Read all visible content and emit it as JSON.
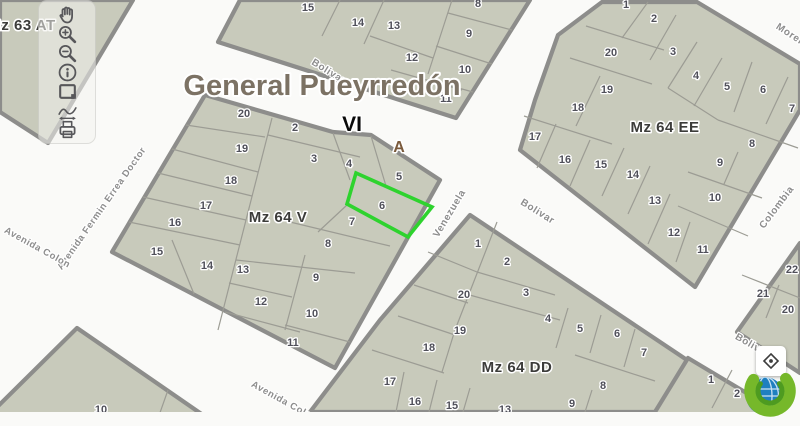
{
  "app": {
    "type": "gis-parcel-map-viewer"
  },
  "colors": {
    "street_bg": "#fafaf8",
    "block_fill": "#c8cabb",
    "block_stroke": "#8d8d8b",
    "parcel_line": "#9c9c94",
    "highlight": "#2ed32e"
  },
  "toolbar": {
    "items": [
      {
        "name": "pan",
        "title": "Pan"
      },
      {
        "name": "zoom-in",
        "title": "Zoom in"
      },
      {
        "name": "zoom-out",
        "title": "Zoom out"
      },
      {
        "name": "identify",
        "title": "Identify"
      },
      {
        "name": "zoom-extent",
        "title": "Zoom to extent"
      },
      {
        "name": "measure",
        "title": "Measure"
      },
      {
        "name": "print",
        "title": "Print"
      }
    ]
  },
  "controls": {
    "geolocate": {
      "title": "Locate"
    }
  },
  "map": {
    "blocks": [
      {
        "name": "mz-63-at",
        "label": "Mz 63 AT",
        "label_x": 22,
        "label_y": 30,
        "polygon": [
          [
            0,
            0
          ],
          [
            133,
            0
          ],
          [
            48,
            143
          ],
          [
            0,
            112
          ]
        ],
        "dividers": [],
        "parcels": []
      },
      {
        "name": "north-block",
        "polygon": [
          [
            240,
            0
          ],
          [
            530,
            0
          ],
          [
            456,
            118
          ],
          [
            218,
            42
          ]
        ],
        "dividers": [
          [
            340,
            0,
            322,
            36
          ],
          [
            384,
            0,
            364,
            44
          ],
          [
            370,
            36,
            433,
            58
          ],
          [
            391,
            70,
            462,
            90
          ],
          [
            452,
            0,
            428,
            74
          ],
          [
            448,
            13,
            512,
            30
          ],
          [
            436,
            46,
            492,
            64
          ],
          [
            429,
            80,
            473,
            92
          ]
        ],
        "parcels": [
          {
            "n": "15",
            "x": 308,
            "y": 7
          },
          {
            "n": "14",
            "x": 358,
            "y": 22
          },
          {
            "n": "13",
            "x": 394,
            "y": 25
          },
          {
            "n": "8",
            "x": 478,
            "y": 3
          },
          {
            "n": "9",
            "x": 469,
            "y": 33
          },
          {
            "n": "12",
            "x": 412,
            "y": 57
          },
          {
            "n": "10",
            "x": 465,
            "y": 69
          },
          {
            "n": "11",
            "x": 446,
            "y": 98
          }
        ]
      },
      {
        "name": "mz-64-v",
        "label": "Mz 64 V",
        "label_x": 278,
        "label_y": 222,
        "polygon": [
          [
            205,
            95
          ],
          [
            333,
            132
          ],
          [
            371,
            135
          ],
          [
            440,
            180
          ],
          [
            335,
            368
          ],
          [
            112,
            252
          ]
        ],
        "dividers": [
          [
            186,
            125,
            265,
            137
          ],
          [
            172,
            149,
            258,
            172
          ],
          [
            158,
            173,
            252,
            196
          ],
          [
            143,
            197,
            246,
            220
          ],
          [
            129,
            222,
            240,
            245
          ],
          [
            272,
            118,
            218,
            330
          ],
          [
            172,
            240,
            194,
            294
          ],
          [
            229,
            283,
            292,
            297
          ],
          [
            225,
            312,
            300,
            332
          ],
          [
            236,
            260,
            355,
            273
          ],
          [
            305,
            255,
            285,
            330
          ],
          [
            285,
            325,
            350,
            342
          ],
          [
            290,
            222,
            390,
            246
          ],
          [
            268,
            135,
            360,
            157
          ],
          [
            333,
            133,
            350,
            180
          ],
          [
            371,
            136,
            386,
            186
          ],
          [
            347,
            205,
            318,
            232
          ]
        ],
        "parcels": [
          {
            "n": "20",
            "x": 244,
            "y": 113
          },
          {
            "n": "2",
            "x": 295,
            "y": 127
          },
          {
            "n": "19",
            "x": 242,
            "y": 148
          },
          {
            "n": "3",
            "x": 314,
            "y": 158
          },
          {
            "n": "4",
            "x": 349,
            "y": 163
          },
          {
            "n": "5",
            "x": 399,
            "y": 176
          },
          {
            "n": "18",
            "x": 231,
            "y": 180
          },
          {
            "n": "6",
            "x": 382,
            "y": 205
          },
          {
            "n": "17",
            "x": 206,
            "y": 205
          },
          {
            "n": "7",
            "x": 352,
            "y": 221
          },
          {
            "n": "16",
            "x": 175,
            "y": 222
          },
          {
            "n": "8",
            "x": 328,
            "y": 243
          },
          {
            "n": "15",
            "x": 157,
            "y": 251
          },
          {
            "n": "14",
            "x": 207,
            "y": 265
          },
          {
            "n": "13",
            "x": 243,
            "y": 269
          },
          {
            "n": "9",
            "x": 316,
            "y": 277
          },
          {
            "n": "12",
            "x": 261,
            "y": 301
          },
          {
            "n": "10",
            "x": 312,
            "y": 313
          },
          {
            "n": "11",
            "x": 293,
            "y": 342
          }
        ]
      },
      {
        "name": "mz-64-ee",
        "label": "Mz 64 EE",
        "label_x": 665,
        "label_y": 132,
        "polygon": [
          [
            520,
            150
          ],
          [
            535,
            100
          ],
          [
            558,
            35
          ],
          [
            602,
            2
          ],
          [
            697,
            2
          ],
          [
            800,
            64
          ],
          [
            800,
            110
          ],
          [
            695,
            287
          ]
        ],
        "dividers": [
          [
            648,
            2,
            622,
            38
          ],
          [
            676,
            15,
            650,
            60
          ],
          [
            697,
            42,
            668,
            88
          ],
          [
            722,
            58,
            694,
            106
          ],
          [
            752,
            62,
            734,
            112
          ],
          [
            788,
            77,
            766,
            124
          ],
          [
            718,
            120,
            798,
            148
          ],
          [
            738,
            152,
            724,
            184
          ],
          [
            688,
            172,
            762,
            198
          ],
          [
            678,
            206,
            748,
            236
          ],
          [
            690,
            222,
            676,
            262
          ],
          [
            670,
            194,
            648,
            244
          ],
          [
            650,
            166,
            628,
            214
          ],
          [
            624,
            148,
            602,
            196
          ],
          [
            590,
            140,
            570,
            186
          ],
          [
            556,
            124,
            537,
            168
          ],
          [
            524,
            116,
            612,
            144
          ],
          [
            600,
            76,
            576,
            126
          ],
          [
            570,
            58,
            652,
            84
          ],
          [
            586,
            26,
            664,
            50
          ],
          [
            668,
            88,
            718,
            120
          ]
        ],
        "parcels": [
          {
            "n": "1",
            "x": 626,
            "y": 4
          },
          {
            "n": "2",
            "x": 654,
            "y": 18
          },
          {
            "n": "20",
            "x": 611,
            "y": 52
          },
          {
            "n": "3",
            "x": 673,
            "y": 51
          },
          {
            "n": "4",
            "x": 696,
            "y": 75
          },
          {
            "n": "5",
            "x": 727,
            "y": 86
          },
          {
            "n": "6",
            "x": 763,
            "y": 89
          },
          {
            "n": "19",
            "x": 607,
            "y": 89
          },
          {
            "n": "7",
            "x": 792,
            "y": 108
          },
          {
            "n": "18",
            "x": 578,
            "y": 107
          },
          {
            "n": "17",
            "x": 535,
            "y": 136
          },
          {
            "n": "8",
            "x": 752,
            "y": 143
          },
          {
            "n": "16",
            "x": 565,
            "y": 159
          },
          {
            "n": "15",
            "x": 601,
            "y": 164
          },
          {
            "n": "9",
            "x": 720,
            "y": 162
          },
          {
            "n": "14",
            "x": 633,
            "y": 174
          },
          {
            "n": "10",
            "x": 715,
            "y": 197
          },
          {
            "n": "13",
            "x": 655,
            "y": 200
          },
          {
            "n": "12",
            "x": 674,
            "y": 232
          },
          {
            "n": "11",
            "x": 703,
            "y": 249
          }
        ]
      },
      {
        "name": "mz-64-dd",
        "label": "Mz 64 DD",
        "label_x": 517,
        "label_y": 372,
        "polygon": [
          [
            470,
            215
          ],
          [
            690,
            362
          ],
          [
            655,
            412
          ],
          [
            310,
            412
          ],
          [
            380,
            320
          ]
        ],
        "dividers": [
          [
            497,
            222,
            455,
            330
          ],
          [
            428,
            252,
            477,
            272
          ],
          [
            414,
            285,
            468,
            303
          ],
          [
            398,
            316,
            455,
            335
          ],
          [
            372,
            350,
            444,
            373
          ],
          [
            404,
            372,
            396,
            412
          ],
          [
            437,
            380,
            429,
            412
          ],
          [
            470,
            388,
            463,
            412
          ],
          [
            477,
            272,
            555,
            295
          ],
          [
            466,
            294,
            560,
            320
          ],
          [
            568,
            308,
            556,
            348
          ],
          [
            601,
            315,
            590,
            353
          ],
          [
            635,
            329,
            624,
            367
          ],
          [
            575,
            355,
            655,
            381
          ],
          [
            592,
            390,
            585,
            412
          ],
          [
            455,
            330,
            442,
            372
          ]
        ],
        "parcels": [
          {
            "n": "1",
            "x": 478,
            "y": 243
          },
          {
            "n": "2",
            "x": 507,
            "y": 261
          },
          {
            "n": "3",
            "x": 526,
            "y": 292
          },
          {
            "n": "20",
            "x": 464,
            "y": 294
          },
          {
            "n": "4",
            "x": 548,
            "y": 318
          },
          {
            "n": "5",
            "x": 580,
            "y": 328
          },
          {
            "n": "19",
            "x": 460,
            "y": 330
          },
          {
            "n": "6",
            "x": 617,
            "y": 333
          },
          {
            "n": "18",
            "x": 429,
            "y": 347
          },
          {
            "n": "7",
            "x": 644,
            "y": 352
          },
          {
            "n": "17",
            "x": 390,
            "y": 381
          },
          {
            "n": "8",
            "x": 603,
            "y": 385
          },
          {
            "n": "16",
            "x": 415,
            "y": 401
          },
          {
            "n": "9",
            "x": 572,
            "y": 403
          },
          {
            "n": "15",
            "x": 452,
            "y": 405
          },
          {
            "n": "13",
            "x": 505,
            "y": 409
          }
        ]
      },
      {
        "name": "east-corner-block",
        "polygon": [
          [
            800,
            243
          ],
          [
            737,
            332
          ],
          [
            800,
            373
          ]
        ],
        "dividers": [
          [
            742,
            275,
            800,
            298
          ],
          [
            779,
            285,
            766,
            318
          ]
        ],
        "parcels": [
          {
            "n": "22",
            "x": 792,
            "y": 269
          },
          {
            "n": "21",
            "x": 763,
            "y": 293
          },
          {
            "n": "20",
            "x": 788,
            "y": 309
          }
        ]
      },
      {
        "name": "south-east-corner-block",
        "polygon": [
          [
            688,
            358
          ],
          [
            800,
            425
          ],
          [
            800,
            445
          ],
          [
            600,
            445
          ],
          [
            655,
            412
          ]
        ],
        "dividers": [
          [
            732,
            370,
            712,
            408
          ]
        ],
        "parcels": [
          {
            "n": "1",
            "x": 711,
            "y": 379
          },
          {
            "n": "2",
            "x": 737,
            "y": 393
          }
        ]
      },
      {
        "name": "south-west-block",
        "polygon": [
          [
            77,
            328
          ],
          [
            216,
            424
          ],
          [
            -20,
            424
          ]
        ],
        "dividers": [
          [
            168,
            390,
            156,
            424
          ]
        ],
        "parcels": [
          {
            "n": "10",
            "x": 101,
            "y": 409
          }
        ]
      }
    ],
    "highlight": {
      "parcel": "6",
      "polygon": [
        [
          356,
          173
        ],
        [
          432,
          207
        ],
        [
          408,
          237
        ],
        [
          347,
          204
        ]
      ]
    },
    "street_labels": [
      {
        "text": "Bolivar",
        "x": 327,
        "y": 74,
        "rot": 32,
        "size": 10
      },
      {
        "text": "Bolivar",
        "x": 536,
        "y": 214,
        "rot": 32,
        "size": 10
      },
      {
        "text": "Bolivar",
        "x": 751,
        "y": 348,
        "rot": 30,
        "size": 10
      },
      {
        "text": "Moreno",
        "x": 792,
        "y": 39,
        "rot": 33,
        "size": 10
      },
      {
        "text": "Venezuela",
        "x": 452,
        "y": 215,
        "rot": -59,
        "size": 10
      },
      {
        "text": "Colombia",
        "x": 779,
        "y": 209,
        "rot": -53,
        "size": 10
      },
      {
        "text": "Avenida Fermin Errea Doctor",
        "x": 104,
        "y": 210,
        "rot": -55,
        "size": 9.5
      },
      {
        "text": "Avenida Colon",
        "x": 36,
        "y": 250,
        "rot": 29,
        "size": 9.5
      },
      {
        "text": "Avenida Colon",
        "x": 283,
        "y": 404,
        "rot": 29,
        "size": 9.5
      }
    ],
    "overlay_labels": [
      {
        "name": "district-title",
        "text": "General Pueyrredón",
        "x": 322,
        "y": 95,
        "size": 29,
        "color": "#7c7264",
        "halo": 4
      },
      {
        "name": "section-label-vi",
        "text": "VI",
        "x": 352,
        "y": 131,
        "size": 21,
        "color": "#0a0a0a",
        "halo": 3
      },
      {
        "name": "zone-label-a",
        "text": "A",
        "x": 399,
        "y": 152,
        "size": 16,
        "color": "#7a5a3c",
        "halo": 3
      }
    ]
  }
}
